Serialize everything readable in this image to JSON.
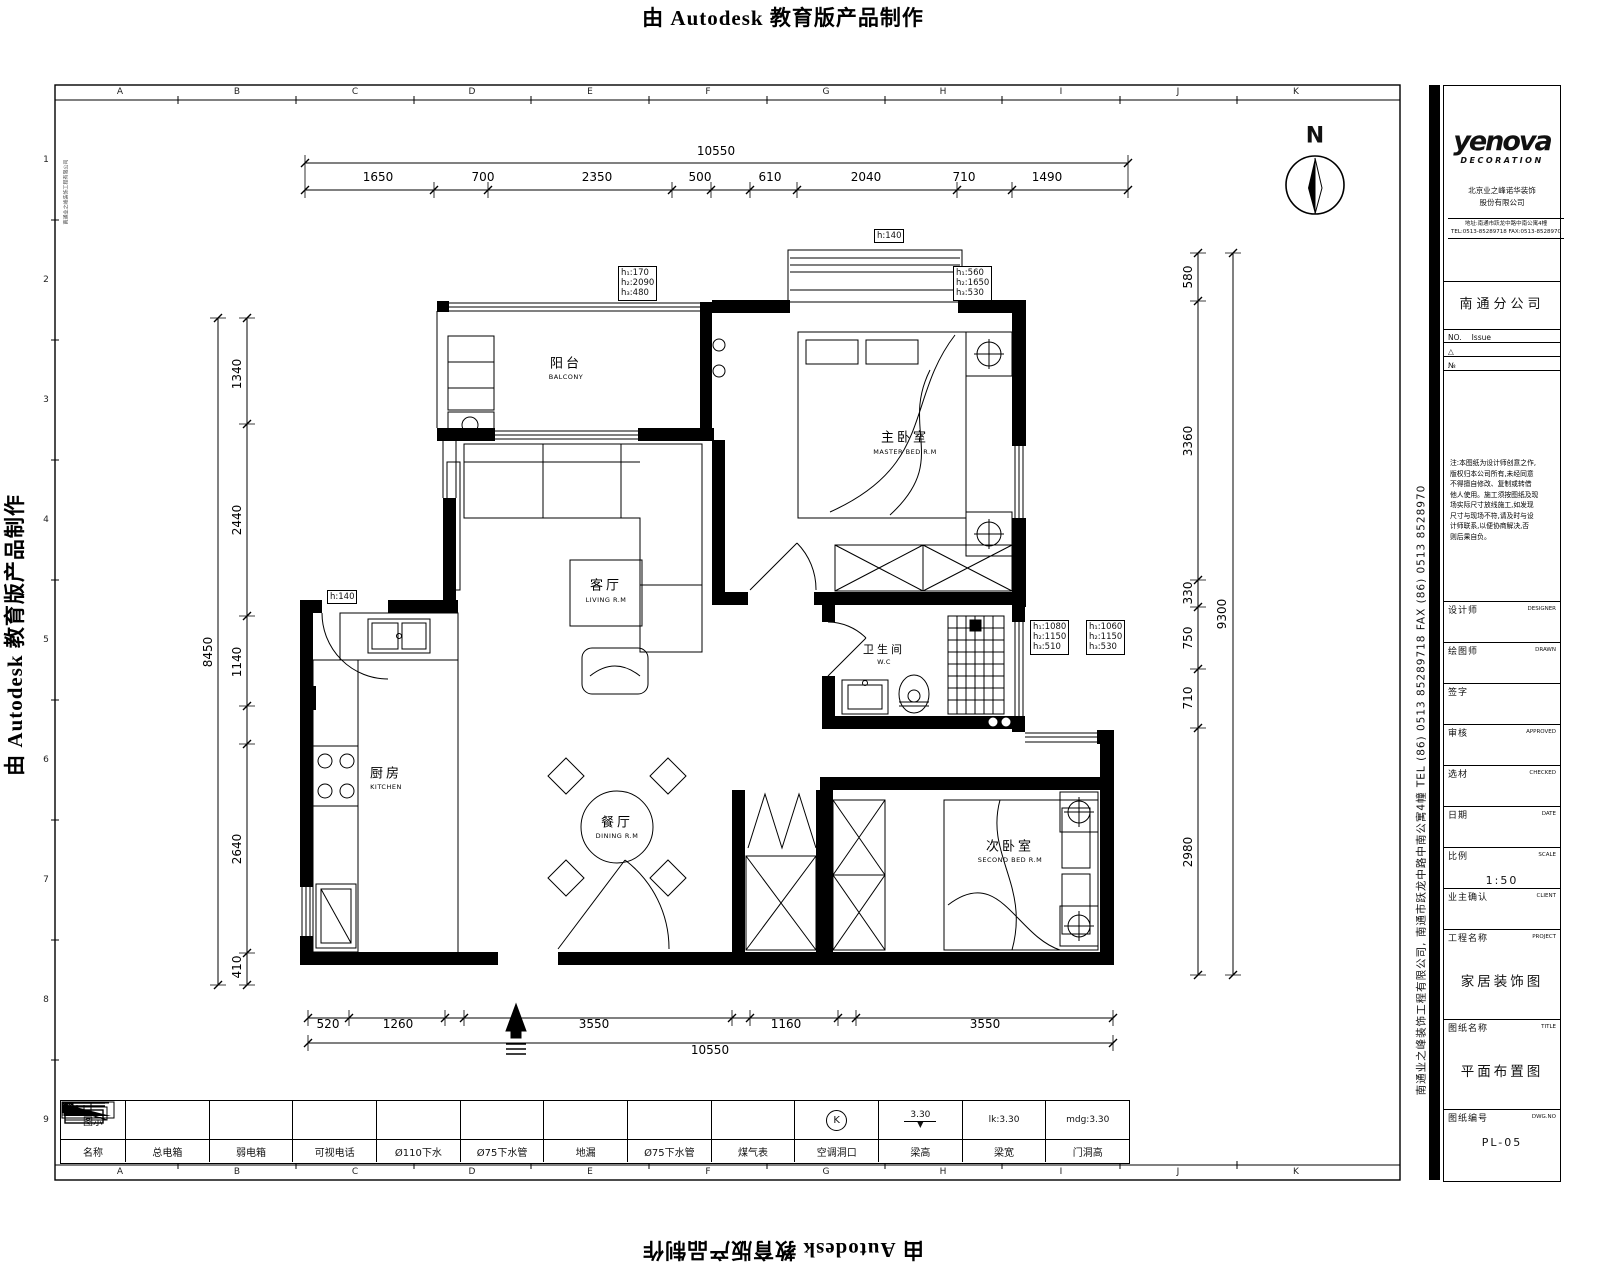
{
  "watermark": {
    "text": "由 Autodesk 教育版产品制作"
  },
  "frame": {
    "cols": [
      "A",
      "B",
      "C",
      "D",
      "E",
      "F",
      "G",
      "H",
      "I",
      "J",
      "K"
    ],
    "rows": [
      "1",
      "2",
      "3",
      "4",
      "5",
      "6",
      "7",
      "8",
      "9"
    ]
  },
  "north_label": "N",
  "dims": {
    "top_overall": "10550",
    "top": [
      "1650",
      "700",
      "2350",
      "500",
      "610",
      "2040",
      "710",
      "1490"
    ],
    "bottom": [
      "520",
      "1260",
      "3550",
      "1160",
      "3550"
    ],
    "bottom_overall": "10550",
    "left_overall": "8450",
    "left": [
      "1340",
      "2440",
      "1140",
      "2640",
      "410"
    ],
    "right_overall": "9300",
    "right": [
      "580",
      "3360",
      "330",
      "750",
      "710",
      "2980"
    ]
  },
  "rooms": {
    "balcony": {
      "cn": "阳台",
      "en": "BALCONY"
    },
    "master": {
      "cn": "主卧室",
      "en": "MASTER BED R.M"
    },
    "living": {
      "cn": "客厅",
      "en": "LIVING R.M"
    },
    "kitchen": {
      "cn": "厨房",
      "en": "KITCHEN"
    },
    "dining": {
      "cn": "餐厅",
      "en": "DINING R.M"
    },
    "bath": {
      "cn": "卫生间",
      "en": "W.C"
    },
    "bed2": {
      "cn": "次卧室",
      "en": "SECOND BED R.M"
    }
  },
  "hboxes": {
    "top": "h:140",
    "kitchen": "h:140",
    "balcony": [
      "h₁:170",
      "h₂:2090",
      "h₃:480"
    ],
    "bay": [
      "h₁:560",
      "h₂:1650",
      "h₃:530"
    ],
    "bath1": [
      "h₁:1080",
      "h₂:1150",
      "h₃:510"
    ],
    "bath2": [
      "h₁:1060",
      "h₂:1150",
      "h₃:530"
    ]
  },
  "legend": {
    "row1": "图示",
    "row2": "名称",
    "items": [
      {
        "name": "总电箱"
      },
      {
        "name": "弱电箱"
      },
      {
        "name": "可视电话"
      },
      {
        "name": "Ø110下水"
      },
      {
        "name": "Ø75下水管"
      },
      {
        "name": "地漏"
      },
      {
        "name": "Ø75下水管"
      },
      {
        "name": "煤气表"
      },
      {
        "name": "空调洞口",
        "k": "K"
      },
      {
        "name": "梁高",
        "value": "3.30"
      },
      {
        "name": "梁宽",
        "value": "lk:3.30"
      },
      {
        "name": "门洞高",
        "value": "mdg:3.30"
      }
    ]
  },
  "titleblock": {
    "logo": "yenova",
    "logo_sub": "DECORATION",
    "company1": "北京业之峰诺华装饰",
    "company2": "股份有限公司",
    "addr1": "地址:南通市跃龙中路中南公寓4幢",
    "addr2": "TEL:0513-85289718  FAX:0513-8528970",
    "branch": "南通分公司",
    "issue_no": "NO.",
    "issue_label": "Issue",
    "issue_r1": "△",
    "issue_r2": "№",
    "notes": [
      "注:本图纸为设计师创意之作,",
      "版权归本公司所有,未经同意",
      "不得擅自修改、复制或转借",
      "他人使用。施工须按图纸及现",
      "场实际尺寸放线施工,如发现",
      "尺寸与现场不符,请及时与设",
      "计师联系,以便协商解决,否",
      "则后果自负。"
    ],
    "fields": [
      {
        "label": "设计师",
        "en": "DESIGNER",
        "value": ""
      },
      {
        "label": "绘图师",
        "en": "DRAWN",
        "value": ""
      },
      {
        "label": "签字",
        "en": "",
        "value": ""
      },
      {
        "label": "审核",
        "en": "APPROVED",
        "value": ""
      },
      {
        "label": "选材",
        "en": "CHECKED",
        "value": ""
      },
      {
        "label": "日期",
        "en": "DATE",
        "value": ""
      },
      {
        "label": "比例",
        "en": "SCALE",
        "value": "1:50"
      },
      {
        "label": "业主确认",
        "en": "CLIENT",
        "value": ""
      },
      {
        "label": "工程名称",
        "en": "PROJECT",
        "value": "家居装饰图"
      },
      {
        "label": "图纸名称",
        "en": "TITLE",
        "value": "平面布置图"
      },
      {
        "label": "图纸编号",
        "en": "DWG.NO",
        "value": "PL-05"
      }
    ],
    "side_company": "南通业之峰装饰工程有限公司, 南通市跃龙中路中南公寓4幢  TEL (86) 0513 85289718  FAX (86) 0513 8528970",
    "frame_note": "南通业之峰装饰工程有限公司"
  }
}
